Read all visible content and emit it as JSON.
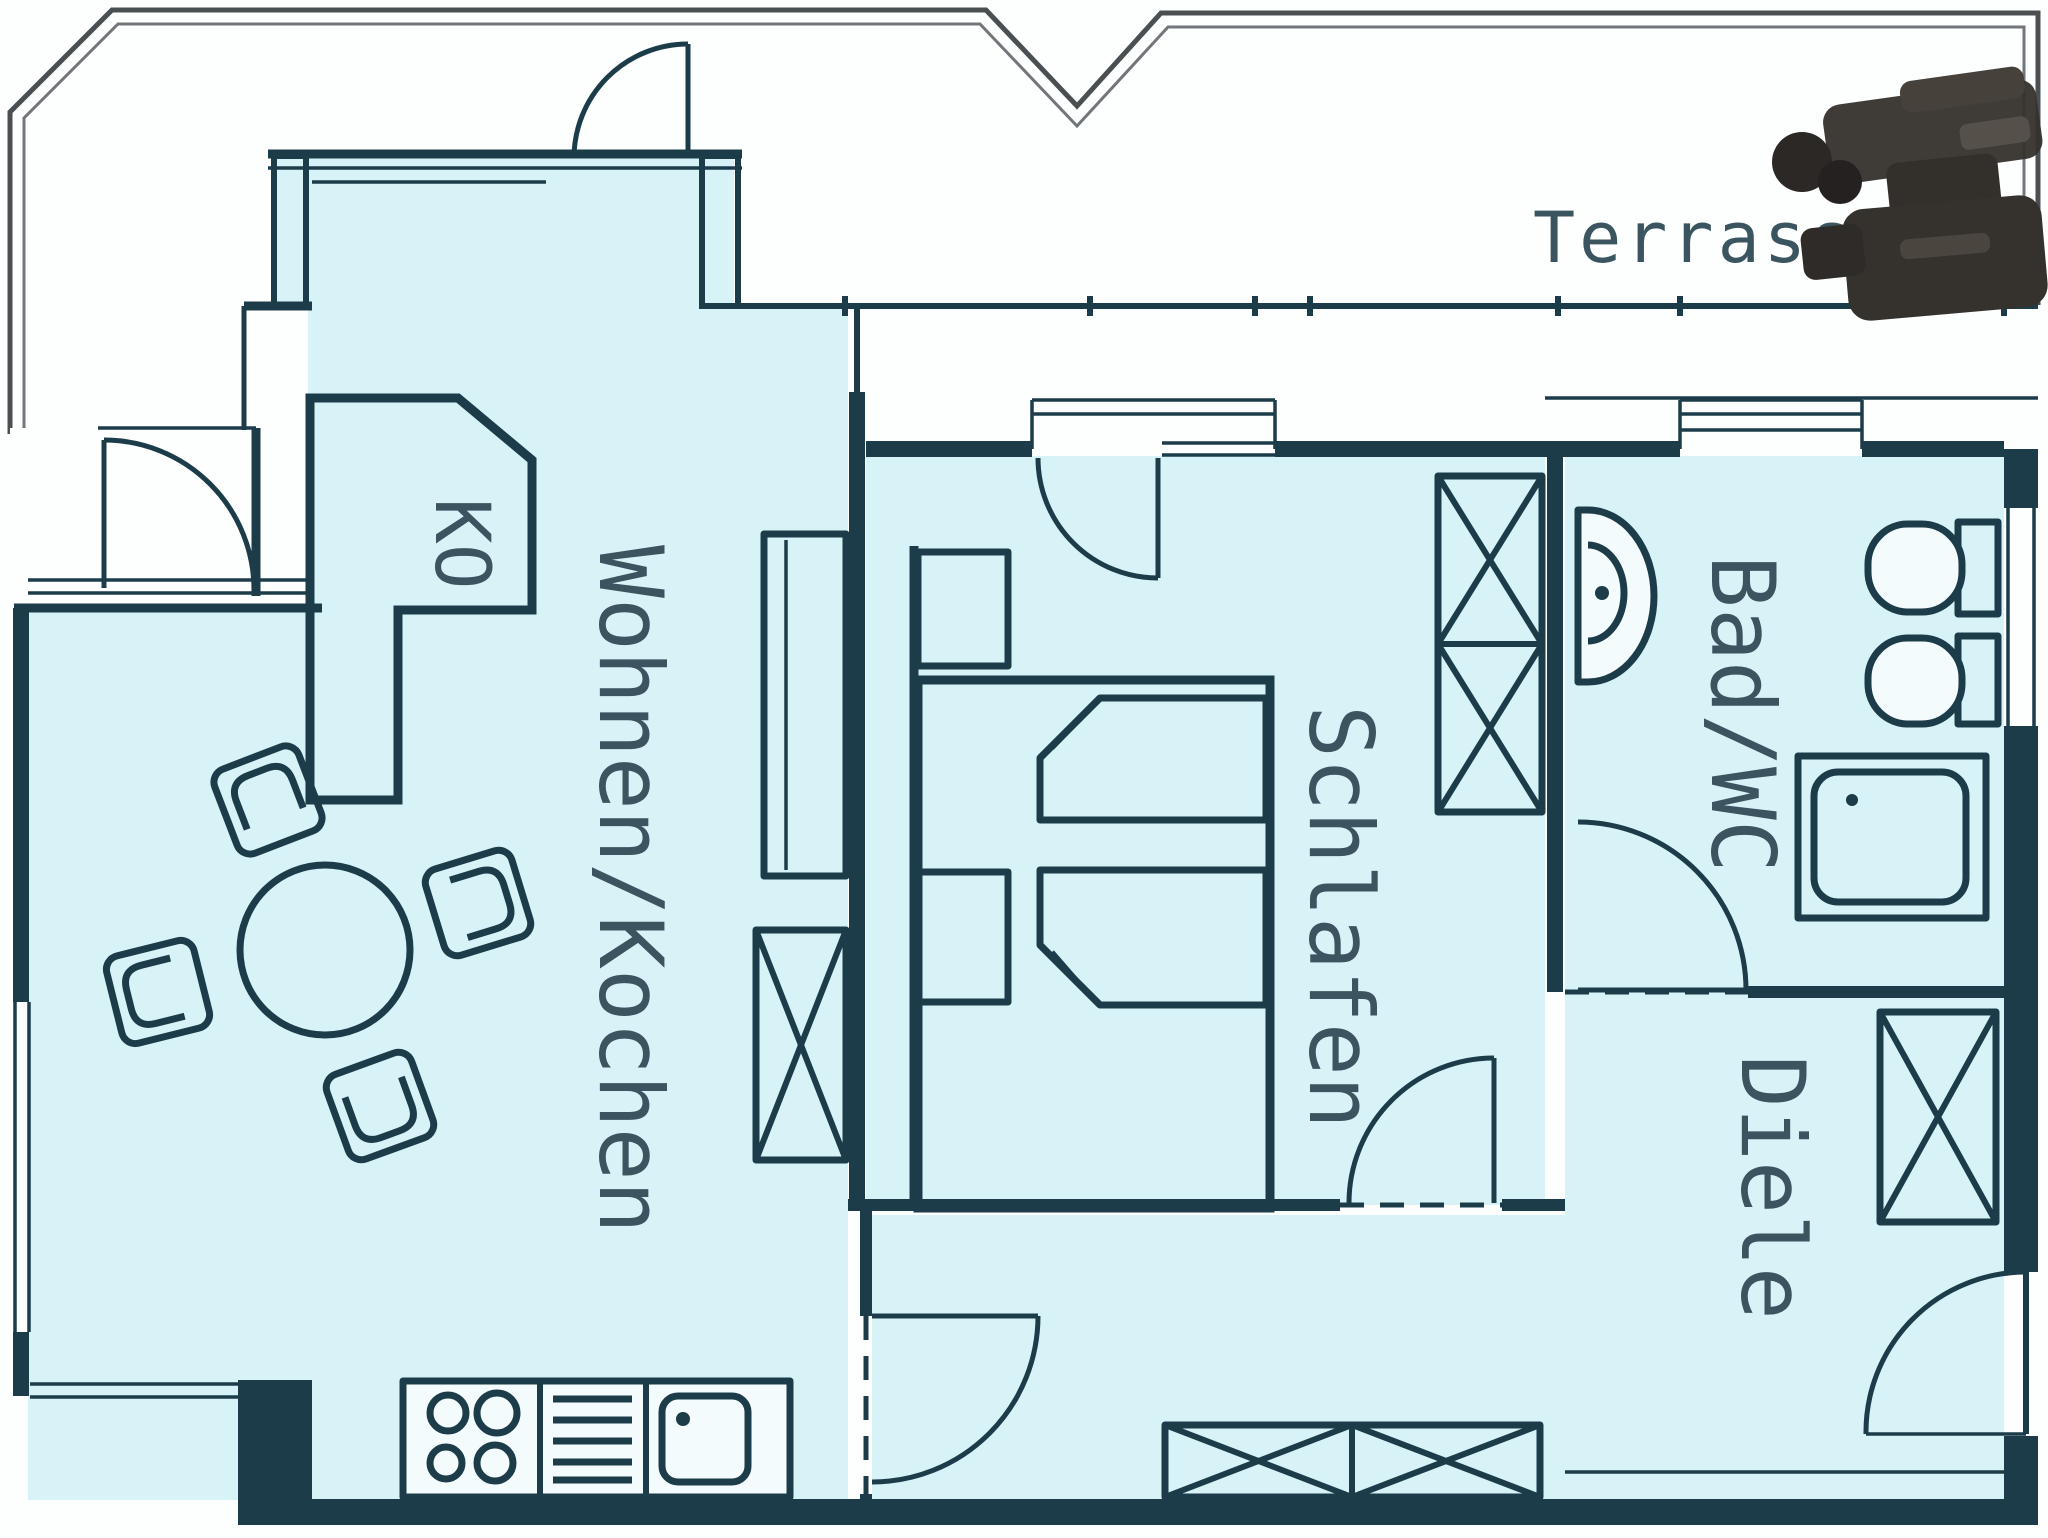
{
  "floorplan": {
    "rooms": {
      "terrasse": {
        "label": "Terrasse"
      },
      "wohnen_kochen": {
        "label": "Wohnen/Kochen"
      },
      "schlafen": {
        "label": "Schlafen"
      },
      "bad_wc": {
        "label": "Bad/WC"
      },
      "diele": {
        "label": "Diele"
      },
      "ko": {
        "label": "KO"
      }
    },
    "colors": {
      "room_fill": "#d8f3f8",
      "wall": "#1d3c4a",
      "boundary": "#4a4f52",
      "label_text": "#3b5560",
      "dark_object": "#35312d",
      "background": "#ffffff"
    }
  }
}
